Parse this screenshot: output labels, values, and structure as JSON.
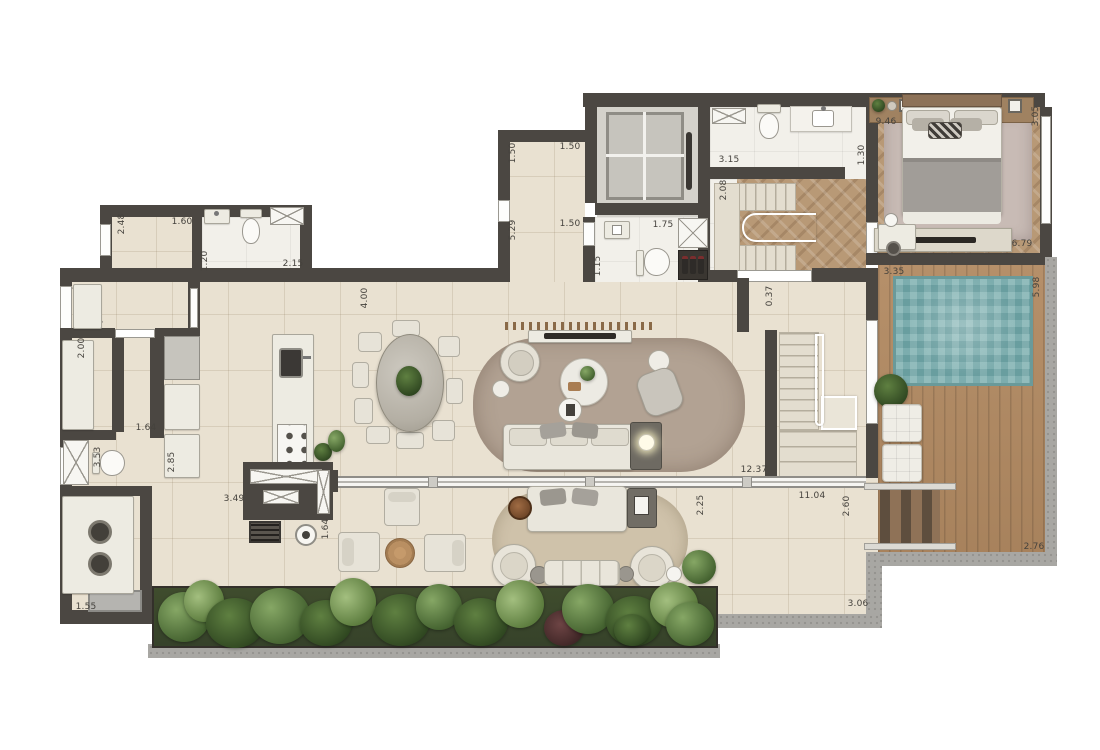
{
  "palette": {
    "wall": "#4b4742",
    "tile": "#e9e1d1",
    "marble": "#f2f0ea",
    "wood_herringbone": "#b89976",
    "deck_wood": "#b28a62",
    "pool_water": "#7fb1b1",
    "concrete": "#a8a7a3",
    "garden_green": "#4a6434",
    "rug_living": "#b2a293",
    "rug_bedroom": "#c8bbb5",
    "rug_terrace": "#cfc2aa",
    "furniture": "#edebe2",
    "text": "#45423d"
  },
  "dimensions": [
    {
      "v": "2.48",
      "x": 122,
      "y": 224,
      "r": 1
    },
    {
      "v": "1.60",
      "x": 182,
      "y": 222,
      "r": 0
    },
    {
      "v": "1.20",
      "x": 205,
      "y": 261,
      "r": 1
    },
    {
      "v": "2.15",
      "x": 293,
      "y": 264,
      "r": 0
    },
    {
      "v": "1.50",
      "x": 513,
      "y": 153,
      "r": 1
    },
    {
      "v": "5.29",
      "x": 513,
      "y": 230,
      "r": 1
    },
    {
      "v": "1.50",
      "x": 570,
      "y": 147,
      "r": 0
    },
    {
      "v": "1.50",
      "x": 570,
      "y": 224,
      "r": 0
    },
    {
      "v": "1.75",
      "x": 663,
      "y": 225,
      "r": 0
    },
    {
      "v": "1.15",
      "x": 598,
      "y": 266,
      "r": 1
    },
    {
      "v": "3.15",
      "x": 729,
      "y": 160,
      "r": 0
    },
    {
      "v": "1.30",
      "x": 862,
      "y": 155,
      "r": 1
    },
    {
      "v": "2.08",
      "x": 724,
      "y": 190,
      "r": 1
    },
    {
      "v": "0.37",
      "x": 770,
      "y": 296,
      "r": 1
    },
    {
      "v": "9.46",
      "x": 886,
      "y": 122,
      "r": 0
    },
    {
      "v": "3.05",
      "x": 1036,
      "y": 116,
      "r": 1
    },
    {
      "v": "6.79",
      "x": 1022,
      "y": 244,
      "r": 0
    },
    {
      "v": "3.35",
      "x": 894,
      "y": 272,
      "r": 0
    },
    {
      "v": "5.98",
      "x": 1037,
      "y": 287,
      "r": 1
    },
    {
      "v": "4.00",
      "x": 365,
      "y": 298,
      "r": 1
    },
    {
      "v": "2.00",
      "x": 82,
      "y": 348,
      "r": 1
    },
    {
      "v": "1.64",
      "x": 146,
      "y": 428,
      "r": 0
    },
    {
      "v": "3.53",
      "x": 98,
      "y": 457,
      "r": 1
    },
    {
      "v": "2.85",
      "x": 172,
      "y": 462,
      "r": 1
    },
    {
      "v": "3.49",
      "x": 234,
      "y": 499,
      "r": 0
    },
    {
      "v": "1.64",
      "x": 326,
      "y": 529,
      "r": 1
    },
    {
      "v": "1.55",
      "x": 86,
      "y": 607,
      "r": 0
    },
    {
      "v": "12.37",
      "x": 754,
      "y": 470,
      "r": 0
    },
    {
      "v": "11.04",
      "x": 812,
      "y": 496,
      "r": 0
    },
    {
      "v": "2.60",
      "x": 847,
      "y": 506,
      "r": 1
    },
    {
      "v": "2.25",
      "x": 701,
      "y": 505,
      "r": 1
    },
    {
      "v": "2.76",
      "x": 1034,
      "y": 547,
      "r": 0
    },
    {
      "v": "3.06",
      "x": 858,
      "y": 604,
      "r": 0
    }
  ]
}
